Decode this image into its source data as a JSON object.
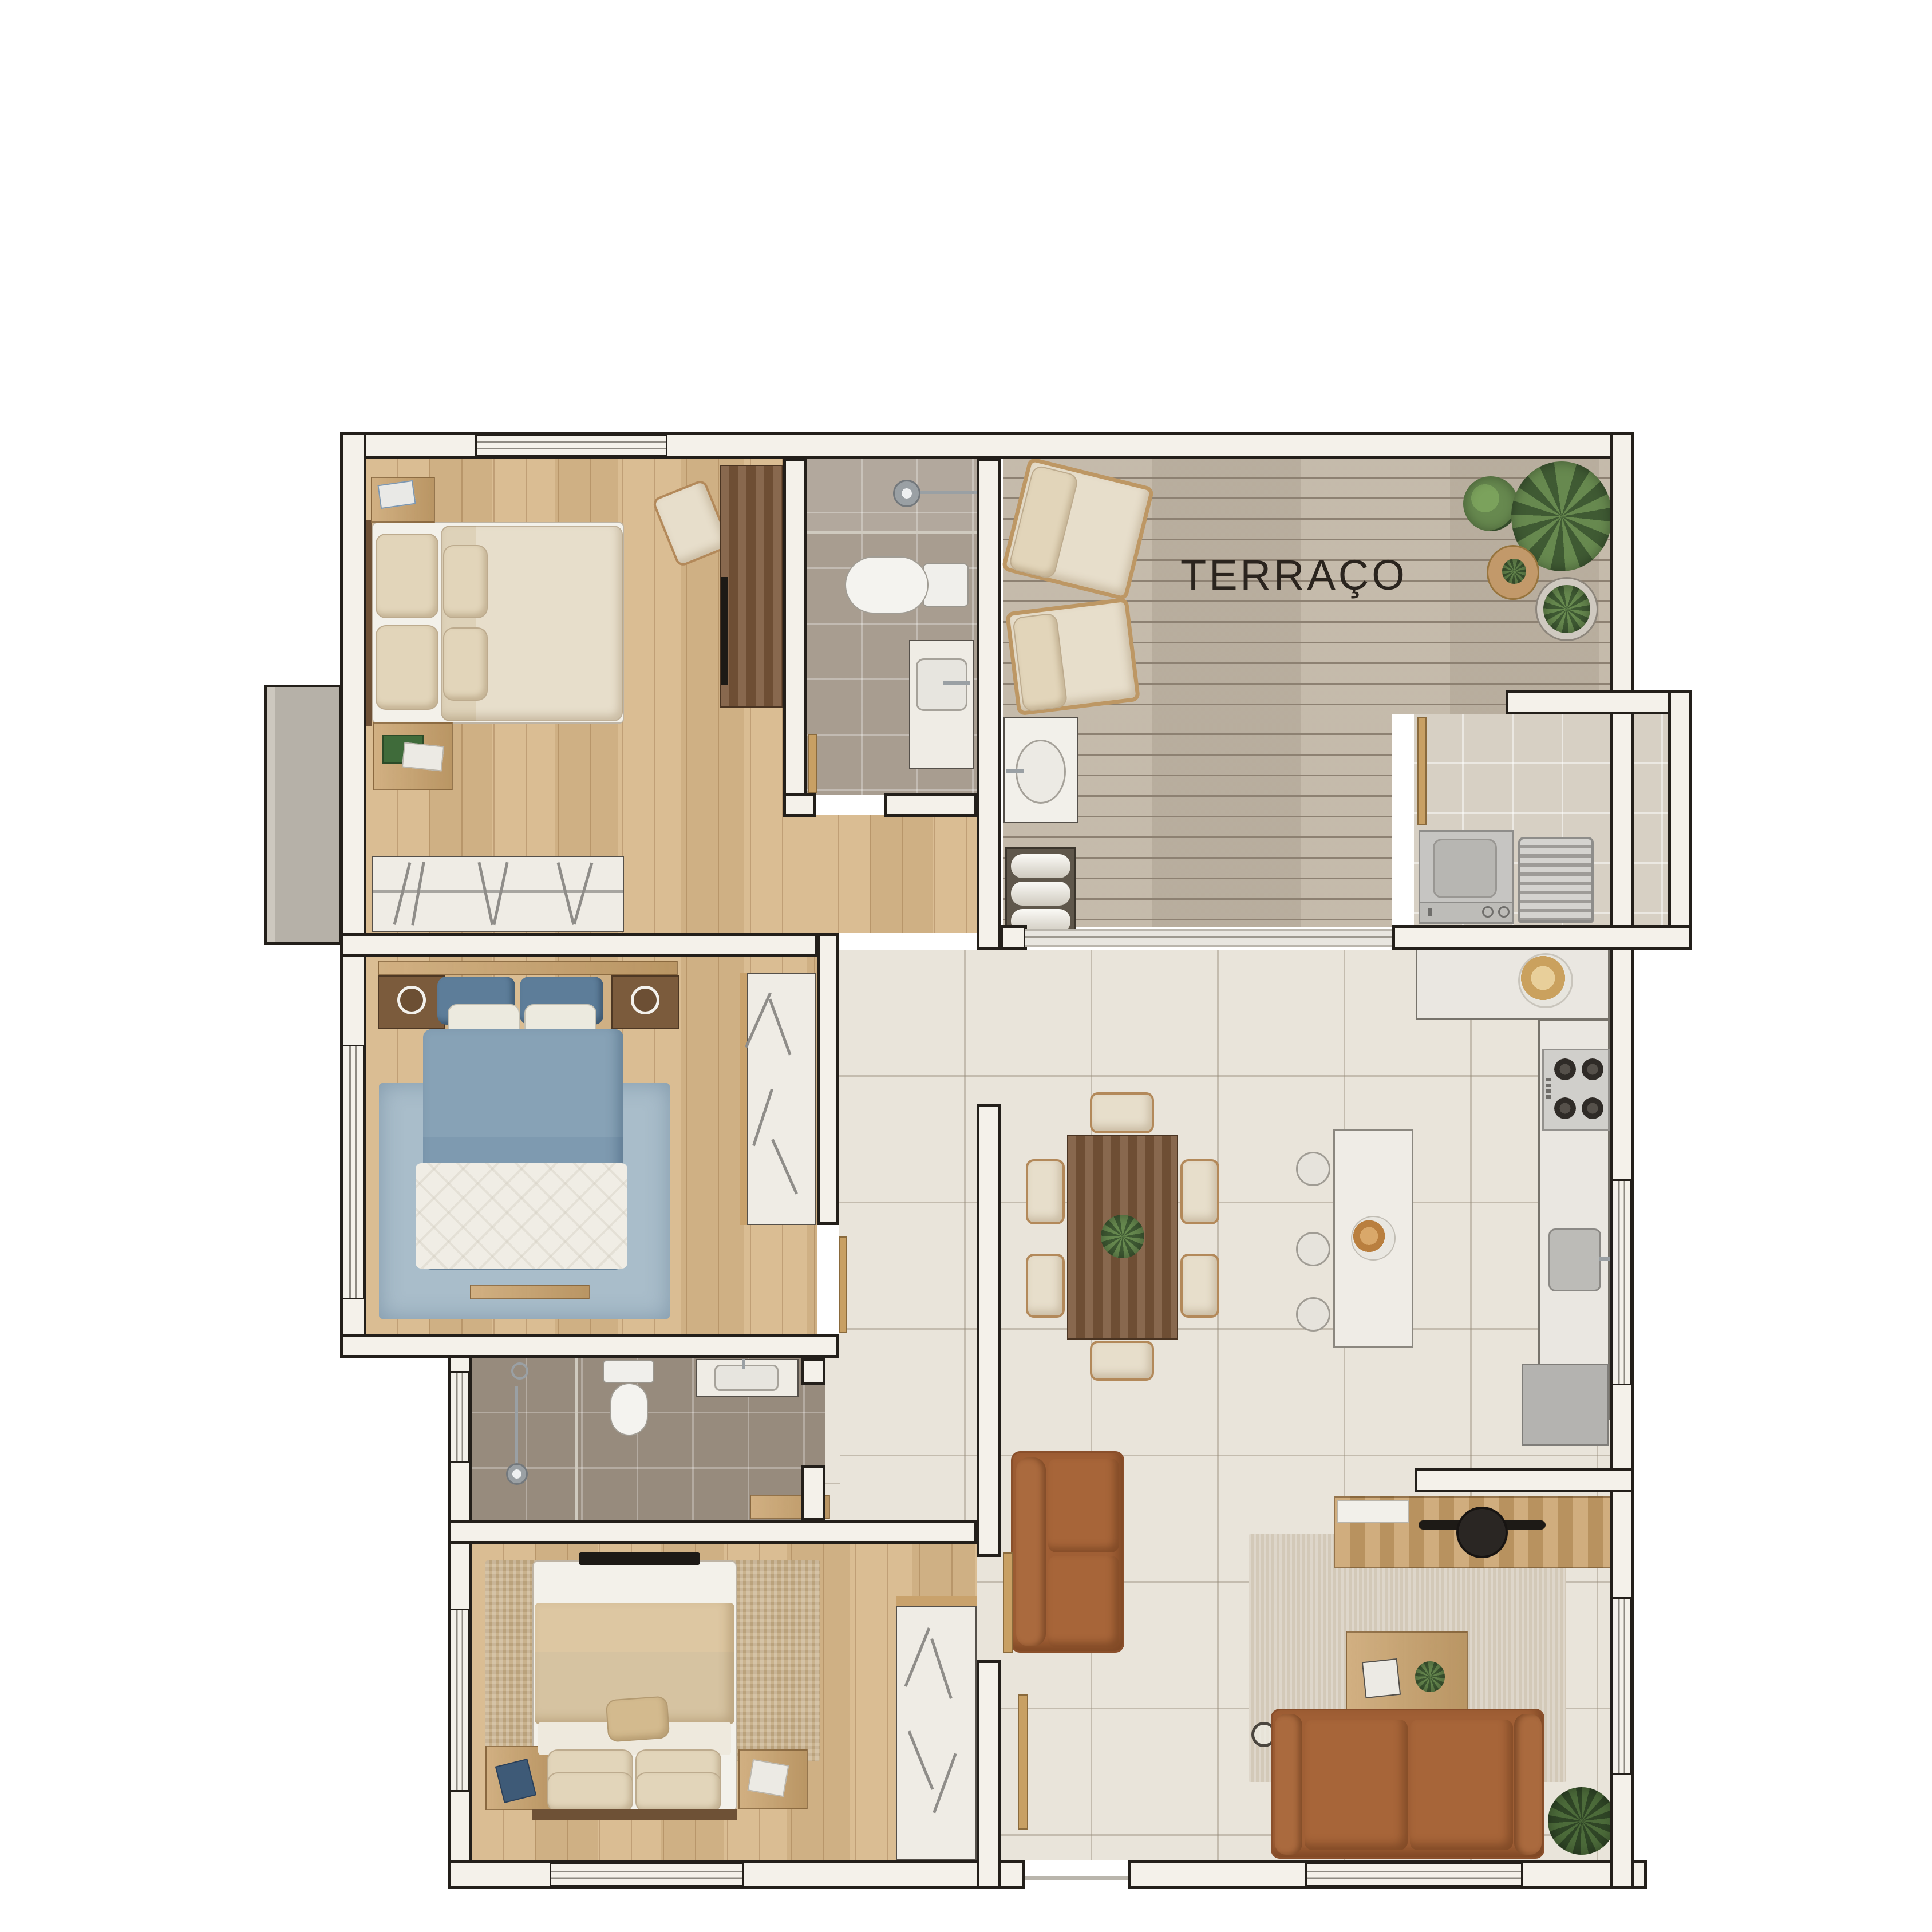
{
  "labels": {
    "terrace": "TERRAÇO"
  },
  "palette": {
    "background": "#ffffff",
    "wall_fill": "#f4f1ea",
    "wall_edge": "#231f1a",
    "wood_floor": "#d8b98c",
    "deck_wood": "#c2b7a7",
    "hall_tile": "#e9e4da",
    "bathroom1_tile": "#a89d90",
    "bathroom2_tile": "#978b7d",
    "laundry_tile": "#d7d0c4",
    "bed_cream": "#e7decb",
    "bed_blue_duvet": "#7e9ab0",
    "bed_blue_pillow": "#5d7d99",
    "blue_rug": "#a9bdca",
    "jute_rug": "#c9b28d",
    "leather_sofa": "#a05f35",
    "walnut_table": "#7a573a",
    "oak_furniture": "#c9a26c",
    "plant_green": "#67894f",
    "appliance_gray": "#c6c5c2",
    "chrome": "#9aa0a4",
    "label_text": "#2a241e"
  },
  "rooms": [
    {
      "id": "bedroom-1",
      "label": ""
    },
    {
      "id": "bathroom-1",
      "label": ""
    },
    {
      "id": "terrace",
      "label": "TERRAÇO"
    },
    {
      "id": "laundry",
      "label": ""
    },
    {
      "id": "bedroom-2",
      "label": ""
    },
    {
      "id": "bathroom-2",
      "label": ""
    },
    {
      "id": "bedroom-3",
      "label": ""
    },
    {
      "id": "kitchen",
      "label": ""
    },
    {
      "id": "dining",
      "label": ""
    },
    {
      "id": "living",
      "label": ""
    },
    {
      "id": "hall",
      "label": ""
    }
  ]
}
